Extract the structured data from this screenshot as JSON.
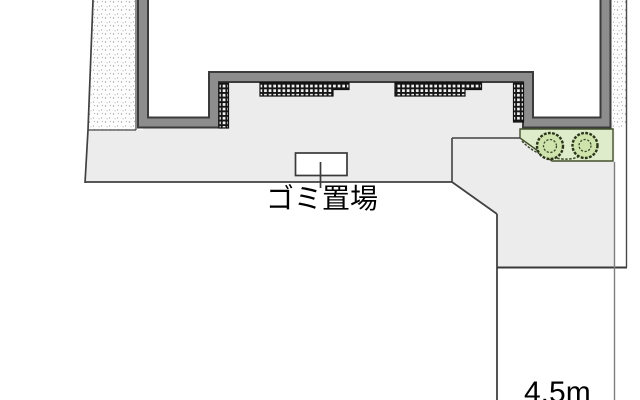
{
  "labels": {
    "garbage_area": "ゴミ置場",
    "road_width": "4.5m"
  },
  "colors": {
    "paving": "#ececec",
    "wall_edge": "#3b3b3b",
    "wall_fill": "#8d8d8d",
    "green_fill": "#dfeccb",
    "shrub_fill": "#cfe3ad",
    "boundary_line": "#414141",
    "hatch_dark": "#161616",
    "stipple_dot": "#9a9a9a",
    "label_color": "#000000"
  }
}
